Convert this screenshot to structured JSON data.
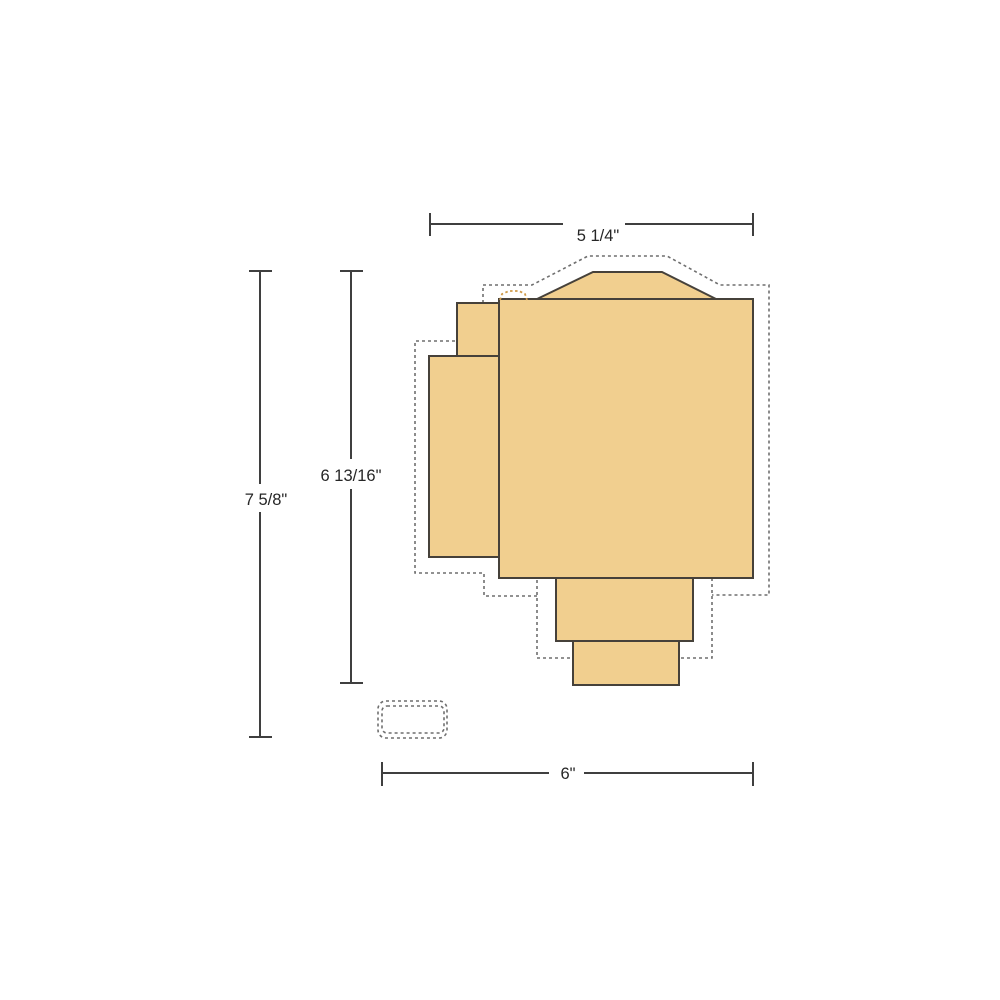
{
  "diagram": {
    "type": "product-dimension-drawing",
    "dimensions": {
      "width_top": {
        "label": "5 1/4\""
      },
      "height_overall": {
        "label": "7 5/8\""
      },
      "height_body": {
        "label": "6 13/16\""
      },
      "width_overall": {
        "label": "6\""
      }
    },
    "colors": {
      "background": "#ffffff",
      "body_fill": "#f1cf8f",
      "body_outline": "#46413a",
      "dimension_line": "#3f3f3f",
      "hidden_line_dash": "#6f6f6f",
      "accent_dash": "#cf9b4a"
    }
  }
}
